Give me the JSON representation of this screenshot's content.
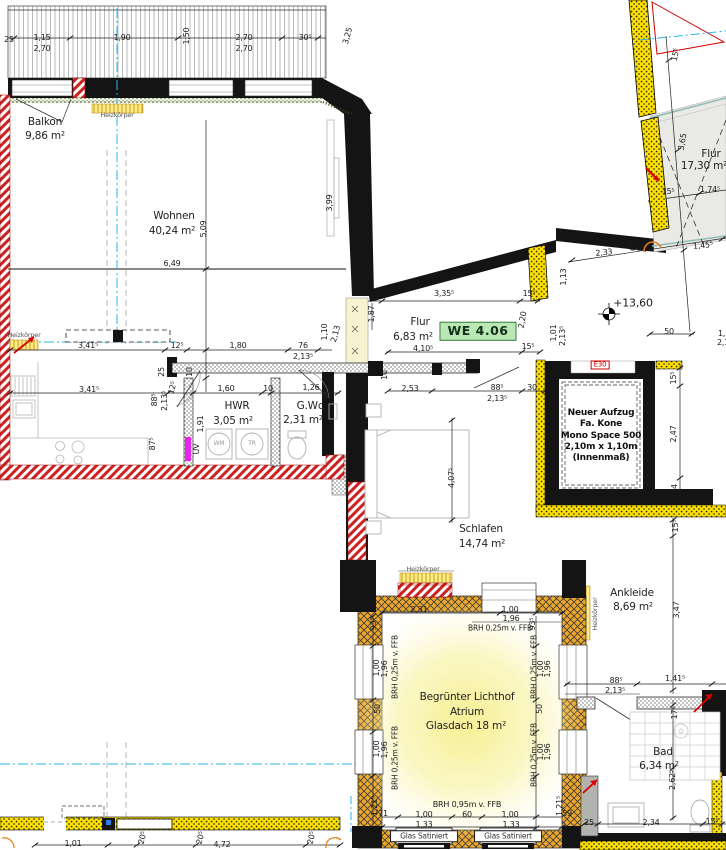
{
  "plan": {
    "type": "architectural-floor-plan",
    "unit_badge": "WE 4.06",
    "fire_label": "E30",
    "elevation_mark": "+13,60",
    "elevator_note": "Neuer Aufzug\nFa. Kone\nMono Space 500\n2,10m x 1,10m\n(Innenmaß)",
    "glass_panel_label_1": "Glas Satiniert",
    "glass_panel_label_2": "Glas Satiniert",
    "rooms": [
      {
        "label": "Balkon",
        "area": "9,86 m²"
      },
      {
        "label": "Wohnen",
        "area": "40,24 m²"
      },
      {
        "label": "Flur",
        "area": "6,83 m²"
      },
      {
        "label": "HWR",
        "area": "3,05 m²"
      },
      {
        "label": "G.Wc",
        "area": "2,31 m²"
      },
      {
        "label": "Schlafen",
        "area": "14,74 m²"
      },
      {
        "label": "Ankleide",
        "area": "8,69 m²"
      },
      {
        "label": "Bad",
        "area": "6,34 m²"
      },
      {
        "label": "Flur",
        "area": "17,30 m²"
      },
      {
        "label": "Begrünter Lichthof Atrium",
        "area": "Glasdach 18 m²"
      }
    ],
    "colors": {
      "wall": "#141414",
      "demolition_red": "#cc2222",
      "new_wall_yellow": "#ffe200",
      "atrium_wall_orange": "#eda728",
      "axis_cyan": "#29b6e8",
      "badge_green": "#b9e8b4",
      "heating_yellow": "#ffec85",
      "stair_gray": "#e9e9e6",
      "orange_symbol": "#e8821e"
    },
    "labels": [
      {
        "t": "25",
        "x": 9,
        "y": 40
      },
      {
        "t": "1,15",
        "x": 42,
        "y": 38
      },
      {
        "t": "2,70",
        "x": 42,
        "y": 49
      },
      {
        "t": "1,90",
        "x": 122,
        "y": 38
      },
      {
        "t": "1,50",
        "x": 187,
        "y": 36,
        "r": -90
      },
      {
        "t": "2,70",
        "x": 244,
        "y": 38
      },
      {
        "t": "2,70",
        "x": 244,
        "y": 49
      },
      {
        "t": "30⁵",
        "x": 305,
        "y": 38
      },
      {
        "t": "3,25",
        "x": 348,
        "y": 36,
        "r": -75
      },
      {
        "t": "Balkon",
        "x": 45,
        "y": 122,
        "cls": "room",
        "name": "room-label-balkon"
      },
      {
        "t": "9,86 m²",
        "x": 45,
        "y": 136,
        "cls": "room",
        "name": "room-area-balkon"
      },
      {
        "t": "Heizkörper",
        "x": 117,
        "y": 115,
        "cls": "tiny",
        "name": "heizkoerper-label"
      },
      {
        "t": "Wohnen",
        "x": 174,
        "y": 216,
        "cls": "room",
        "name": "room-label-wohnen"
      },
      {
        "t": "40,24 m²",
        "x": 172,
        "y": 231,
        "cls": "room",
        "name": "room-area-wohnen"
      },
      {
        "t": "5,09",
        "x": 204,
        "y": 229,
        "r": -90
      },
      {
        "t": "6,49",
        "x": 172,
        "y": 264
      },
      {
        "t": "3,99",
        "x": 330,
        "y": 203,
        "r": -90
      },
      {
        "t": "Heizkörper",
        "x": 24,
        "y": 335,
        "cls": "tiny",
        "name": "heizkoerper-label"
      },
      {
        "t": "3,41⁵",
        "x": 88,
        "y": 346
      },
      {
        "t": "12⁵",
        "x": 177,
        "y": 346
      },
      {
        "t": "1,80",
        "x": 238,
        "y": 346
      },
      {
        "t": "76",
        "x": 303,
        "y": 346
      },
      {
        "t": "2,13⁵",
        "x": 303,
        "y": 357
      },
      {
        "t": "1,10",
        "x": 325,
        "y": 332,
        "r": -90
      },
      {
        "t": "2,13",
        "x": 336,
        "y": 334,
        "r": -75
      },
      {
        "t": "3,41⁵",
        "x": 89,
        "y": 390
      },
      {
        "t": "25",
        "x": 162,
        "y": 372,
        "r": -90
      },
      {
        "t": "10",
        "x": 190,
        "y": 372,
        "r": -90
      },
      {
        "t": "88⁵",
        "x": 155,
        "y": 400,
        "r": -90
      },
      {
        "t": "2,13⁵",
        "x": 165,
        "y": 401,
        "r": -90
      },
      {
        "t": "12⁵",
        "x": 173,
        "y": 388,
        "r": -75
      },
      {
        "t": "1,60",
        "x": 226,
        "y": 389
      },
      {
        "t": "10",
        "x": 268,
        "y": 389
      },
      {
        "t": "1,26",
        "x": 311,
        "y": 388
      },
      {
        "t": "HWR",
        "x": 237,
        "y": 406,
        "cls": "room",
        "name": "room-label-hwr"
      },
      {
        "t": "3,05 m²",
        "x": 233,
        "y": 421,
        "cls": "room",
        "name": "room-area-hwr"
      },
      {
        "t": "G.Wc",
        "x": 310,
        "y": 406,
        "cls": "room",
        "name": "room-label-gwc"
      },
      {
        "t": "2,31 m²",
        "x": 303,
        "y": 420,
        "cls": "room",
        "name": "room-area-gwc"
      },
      {
        "t": "1,91",
        "x": 201,
        "y": 424,
        "r": -90
      },
      {
        "t": "UV",
        "x": 197,
        "y": 449,
        "r": -90,
        "s": 8
      },
      {
        "t": "87⁵",
        "x": 153,
        "y": 444,
        "r": -90
      },
      {
        "t": "WM",
        "x": 219,
        "y": 444,
        "s": 6,
        "c": "#9a9a9a"
      },
      {
        "t": "TR",
        "x": 252,
        "y": 444,
        "s": 6,
        "c": "#9a9a9a"
      },
      {
        "t": "3,35⁵",
        "x": 444,
        "y": 294
      },
      {
        "t": "15⁵",
        "x": 529,
        "y": 294
      },
      {
        "t": "1,87",
        "x": 372,
        "y": 314,
        "r": -90
      },
      {
        "t": "Flur",
        "x": 420,
        "y": 322,
        "cls": "room",
        "name": "room-label-flur"
      },
      {
        "t": "6,83 m²",
        "x": 413,
        "y": 337,
        "cls": "room",
        "name": "room-area-flur"
      },
      {
        "t": "2,20",
        "x": 523,
        "y": 320,
        "r": -80
      },
      {
        "t": "1,01",
        "x": 554,
        "y": 333,
        "r": -90
      },
      {
        "t": "2,13⁵",
        "x": 563,
        "y": 336,
        "r": -90
      },
      {
        "t": "1,13",
        "x": 564,
        "y": 277,
        "r": -90
      },
      {
        "t": "4,10⁵",
        "x": 423,
        "y": 349
      },
      {
        "t": "15⁵",
        "x": 528,
        "y": 347
      },
      {
        "t": "10",
        "x": 385,
        "y": 375,
        "r": -90
      },
      {
        "t": "2,53",
        "x": 410,
        "y": 389
      },
      {
        "t": "88⁵",
        "x": 497,
        "y": 388
      },
      {
        "t": "30",
        "x": 532,
        "y": 388
      },
      {
        "t": "2,13⁵",
        "x": 497,
        "y": 399
      },
      {
        "t": "4,07⁵",
        "x": 452,
        "y": 478,
        "r": -90
      },
      {
        "t": "Schlafen",
        "x": 481,
        "y": 529,
        "cls": "room",
        "name": "room-label-schlafen"
      },
      {
        "t": "14,74 m²",
        "x": 482,
        "y": 544,
        "cls": "room",
        "name": "room-area-schlafen"
      },
      {
        "t": "Heizkörper",
        "x": 423,
        "y": 569,
        "cls": "tiny",
        "name": "heizkoerper-label"
      },
      {
        "t": "15⁵",
        "x": 674,
        "y": 378,
        "r": -90
      },
      {
        "t": "2,47",
        "x": 674,
        "y": 434,
        "r": -90
      },
      {
        "t": "24",
        "x": 675,
        "y": 489,
        "r": -90
      },
      {
        "t": "15⁵",
        "x": 676,
        "y": 526,
        "r": -90
      },
      {
        "t": "Ankleide",
        "x": 632,
        "y": 593,
        "cls": "room",
        "name": "room-label-ankleide"
      },
      {
        "t": "8,69 m²",
        "x": 633,
        "y": 607,
        "cls": "room",
        "name": "room-area-ankleide"
      },
      {
        "t": "Heizkörper",
        "x": 595,
        "y": 614,
        "r": -90,
        "cls": "tiny",
        "name": "heizkoerper-label"
      },
      {
        "t": "3,47",
        "x": 677,
        "y": 610,
        "r": -90
      },
      {
        "t": "88⁵",
        "x": 616,
        "y": 681
      },
      {
        "t": "2,13⁵",
        "x": 615,
        "y": 691
      },
      {
        "t": "1,41⁵",
        "x": 675,
        "y": 679
      },
      {
        "t": "17⁵",
        "x": 675,
        "y": 713,
        "r": -90
      },
      {
        "t": "Bad",
        "x": 663,
        "y": 752,
        "cls": "room",
        "name": "room-label-bad"
      },
      {
        "t": "6,34 m²",
        "x": 659,
        "y": 766,
        "cls": "room",
        "name": "room-area-bad"
      },
      {
        "t": "2,62⁵",
        "x": 673,
        "y": 780,
        "r": -90
      },
      {
        "t": "25",
        "x": 589,
        "y": 823
      },
      {
        "t": "2,34",
        "x": 651,
        "y": 823
      },
      {
        "t": "15⁵",
        "x": 712,
        "y": 822
      },
      {
        "t": "2,31",
        "x": 419,
        "y": 610
      },
      {
        "t": "1,00",
        "x": 510,
        "y": 610
      },
      {
        "t": "1,96",
        "x": 511,
        "y": 619
      },
      {
        "t": "BRH 0,25m v. FFB",
        "x": 500,
        "y": 628,
        "s": 7.5
      },
      {
        "t": "93⁵",
        "x": 374,
        "y": 624,
        "r": -90
      },
      {
        "t": "93⁵",
        "x": 533,
        "y": 624,
        "r": -90
      },
      {
        "t": "BRH 0,25m v. FFB",
        "x": 395,
        "y": 667,
        "r": -90,
        "s": 7.5
      },
      {
        "t": "1,00",
        "x": 377,
        "y": 668,
        "r": -90
      },
      {
        "t": "1,96",
        "x": 385,
        "y": 669,
        "r": -90
      },
      {
        "t": "50",
        "x": 378,
        "y": 709,
        "r": -90
      },
      {
        "t": "BRH 0,25m v. FFB",
        "x": 534,
        "y": 667,
        "r": -90,
        "s": 7.5
      },
      {
        "t": "1,00",
        "x": 541,
        "y": 669,
        "r": -90
      },
      {
        "t": "1,96",
        "x": 548,
        "y": 669,
        "r": -90
      },
      {
        "t": "50",
        "x": 540,
        "y": 709,
        "r": -90
      },
      {
        "t": "Begrünter Lichthof",
        "x": 467,
        "y": 697,
        "cls": "room",
        "name": "room-label-atrium"
      },
      {
        "t": "Atrium",
        "x": 467,
        "y": 712,
        "cls": "room",
        "name": "room-label-atrium"
      },
      {
        "t": "Glasdach 18 m²",
        "x": 466,
        "y": 726,
        "cls": "room",
        "name": "room-area-atrium"
      },
      {
        "t": "BRH 0,25m v. FFB",
        "x": 395,
        "y": 758,
        "r": -90,
        "s": 7.5
      },
      {
        "t": "1,00",
        "x": 377,
        "y": 749,
        "r": -90
      },
      {
        "t": "1,96",
        "x": 385,
        "y": 750,
        "r": -90
      },
      {
        "t": "BRH 0,25m v. FFB",
        "x": 534,
        "y": 755,
        "r": -90,
        "s": 7.5
      },
      {
        "t": "1,00",
        "x": 541,
        "y": 752,
        "r": -90
      },
      {
        "t": "1,96",
        "x": 548,
        "y": 752,
        "r": -90
      },
      {
        "t": "1,21⁵",
        "x": 375,
        "y": 806,
        "r": -90
      },
      {
        "t": "71",
        "x": 383,
        "y": 814
      },
      {
        "t": "1,21⁵",
        "x": 560,
        "y": 806,
        "r": -90
      },
      {
        "t": "59",
        "x": 567,
        "y": 814
      },
      {
        "t": "BRH 0,95m v. FFB",
        "x": 467,
        "y": 805,
        "s": 8
      },
      {
        "t": "1,00",
        "x": 424,
        "y": 815
      },
      {
        "t": "60",
        "x": 467,
        "y": 815
      },
      {
        "t": "1,00",
        "x": 510,
        "y": 815
      },
      {
        "t": "1,33",
        "x": 424,
        "y": 825
      },
      {
        "t": "1,33",
        "x": 511,
        "y": 825
      },
      {
        "t": "1,01",
        "x": 73,
        "y": 844
      },
      {
        "t": "20⁵",
        "x": 143,
        "y": 838,
        "r": -75
      },
      {
        "t": "20⁵",
        "x": 201,
        "y": 838,
        "r": -75
      },
      {
        "t": "4,72",
        "x": 222,
        "y": 845
      },
      {
        "t": "20⁵",
        "x": 312,
        "y": 838,
        "r": -75
      },
      {
        "t": "15⁵",
        "x": 676,
        "y": 55,
        "r": -78
      },
      {
        "t": "3,65",
        "x": 683,
        "y": 142,
        "r": -80
      },
      {
        "t": "Flur",
        "x": 711,
        "y": 154,
        "cls": "room",
        "name": "room-label-treppenhaus-flur"
      },
      {
        "t": "17,30 m²",
        "x": 704,
        "y": 166,
        "cls": "room",
        "name": "room-area-treppenhaus-flur"
      },
      {
        "t": "15⁵",
        "x": 668,
        "y": 192
      },
      {
        "t": "1,74⁵",
        "x": 710,
        "y": 190
      },
      {
        "t": "SD",
        "x": 637,
        "y": 247,
        "s": 11,
        "name": "sd-label"
      },
      {
        "t": "2,33",
        "x": 604,
        "y": 253,
        "r": -6
      },
      {
        "t": "1,45⁵",
        "x": 703,
        "y": 246,
        "r": -6
      },
      {
        "t": "+13,60",
        "x": 633,
        "y": 303,
        "s": 11,
        "name": "elevation-label"
      },
      {
        "t": "50",
        "x": 669,
        "y": 332
      },
      {
        "t": "1,1",
        "x": 724,
        "y": 334
      },
      {
        "t": "2,1",
        "x": 723,
        "y": 343
      }
    ]
  }
}
